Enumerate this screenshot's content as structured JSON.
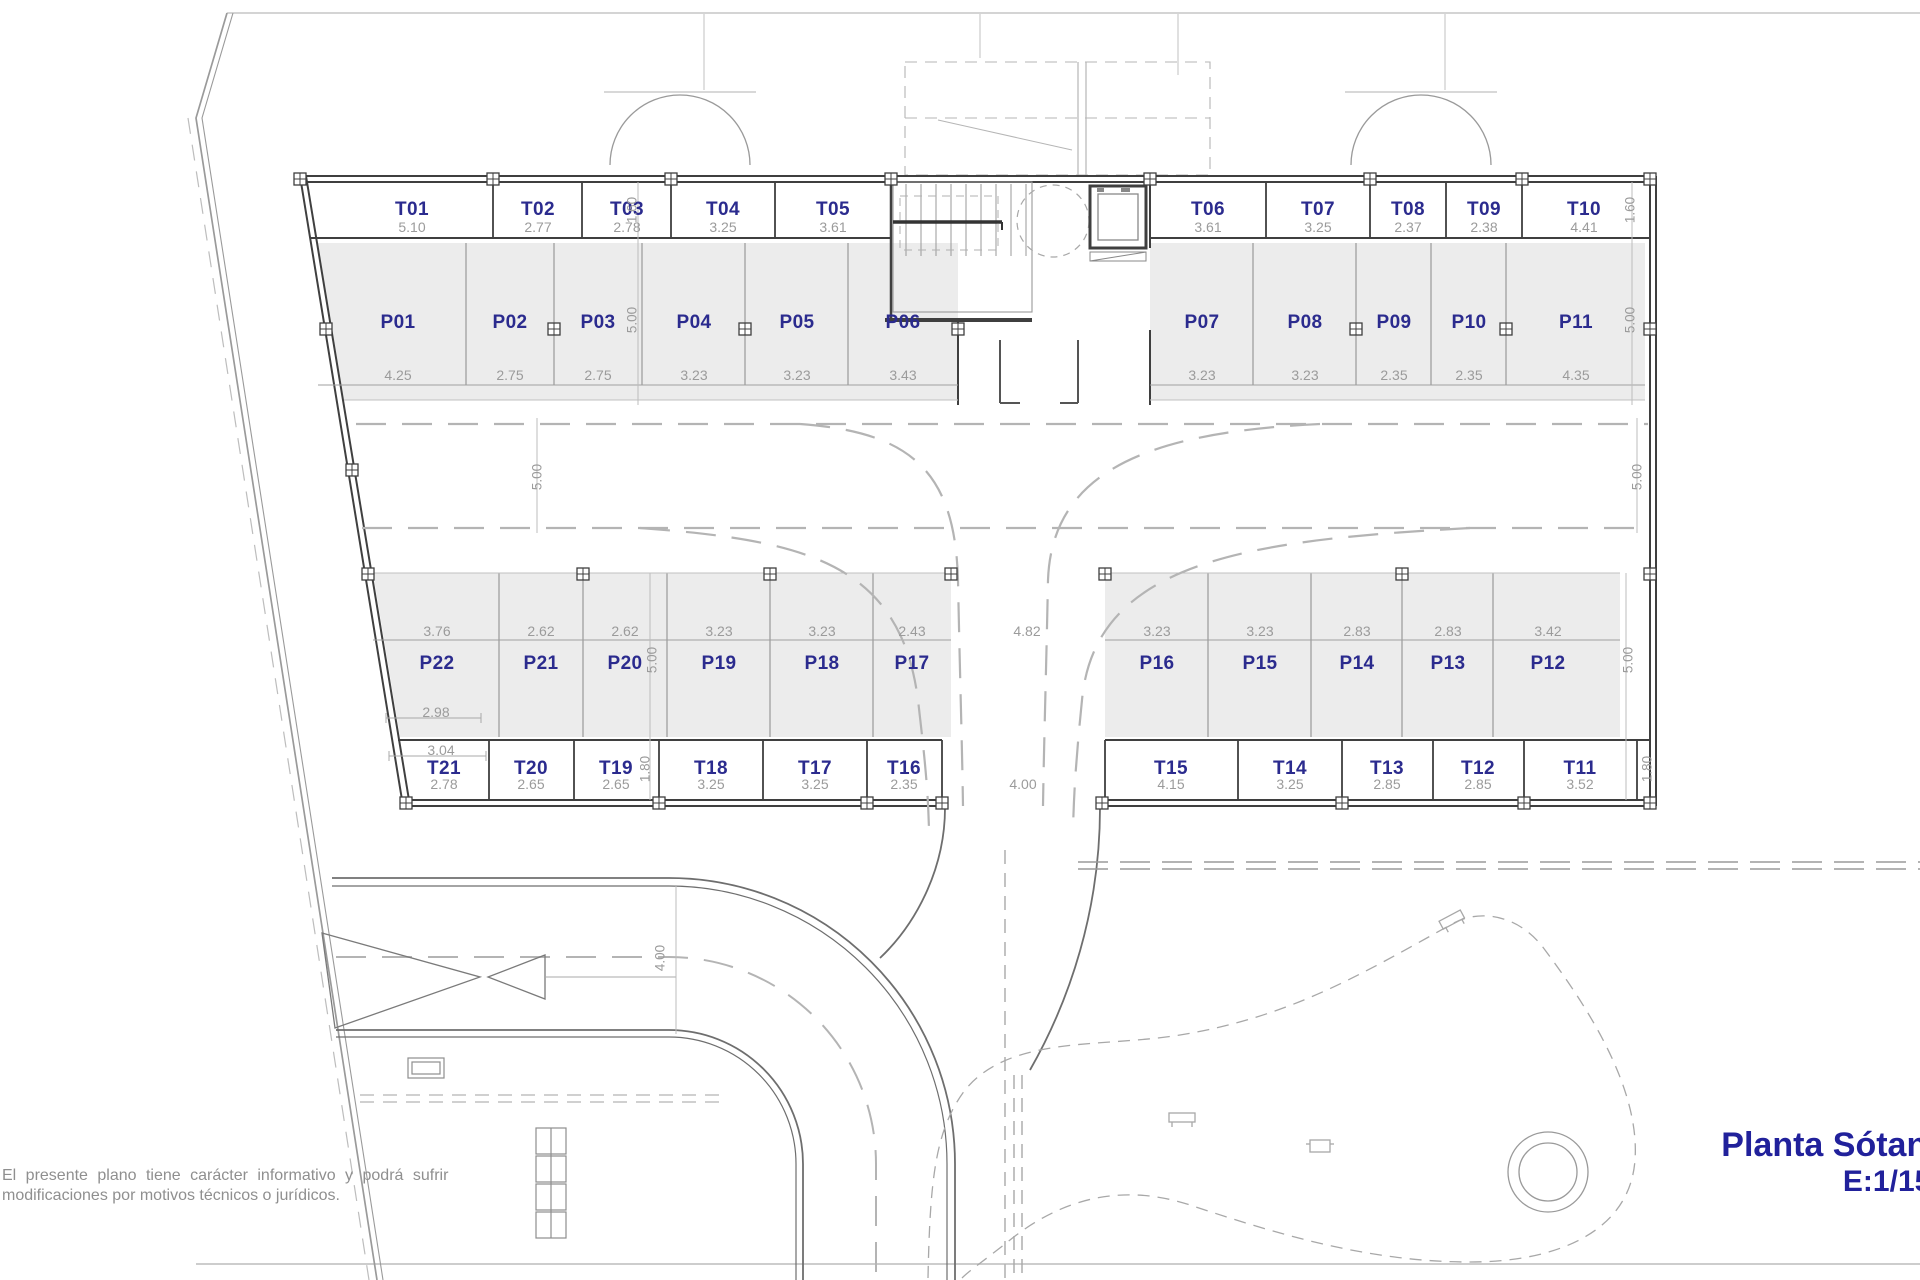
{
  "plan": {
    "title": "Planta Sótano",
    "scale": "E:1/150"
  },
  "disclaimer": {
    "line1": "El presente plano tiene carácter informativo y podrá sufrir",
    "line2": "modificaciones por motivos técnicos o jurídicos."
  },
  "colors": {
    "label_blue": "#2b2b8e",
    "dim_gray": "#9b9b9b",
    "stall_fill": "#ececec",
    "wall_dark": "#3f3f3f",
    "title_blue": "#21219b"
  },
  "storage_top": [
    {
      "id": "T01",
      "dim": "5.10"
    },
    {
      "id": "T02",
      "dim": "2.77"
    },
    {
      "id": "T03",
      "dim": "2.78"
    },
    {
      "id": "T04",
      "dim": "3.25"
    },
    {
      "id": "T05",
      "dim": "3.61"
    },
    {
      "id": "T06",
      "dim": "3.61"
    },
    {
      "id": "T07",
      "dim": "3.25"
    },
    {
      "id": "T08",
      "dim": "2.37"
    },
    {
      "id": "T09",
      "dim": "2.38"
    },
    {
      "id": "T10",
      "dim": "4.41"
    }
  ],
  "parking_top": [
    {
      "id": "P01",
      "dim": "4.25"
    },
    {
      "id": "P02",
      "dim": "2.75"
    },
    {
      "id": "P03",
      "dim": "2.75"
    },
    {
      "id": "P04",
      "dim": "3.23"
    },
    {
      "id": "P05",
      "dim": "3.23"
    },
    {
      "id": "P06",
      "dim": "3.43"
    },
    {
      "id": "P07",
      "dim": "3.23"
    },
    {
      "id": "P08",
      "dim": "3.23"
    },
    {
      "id": "P09",
      "dim": "2.35"
    },
    {
      "id": "P10",
      "dim": "2.35"
    },
    {
      "id": "P11",
      "dim": "4.35"
    }
  ],
  "parking_bottom": [
    {
      "id": "P22",
      "dim": "3.76"
    },
    {
      "id": "P21",
      "dim": "2.62"
    },
    {
      "id": "P20",
      "dim": "2.62"
    },
    {
      "id": "P19",
      "dim": "3.23"
    },
    {
      "id": "P18",
      "dim": "3.23"
    },
    {
      "id": "P17",
      "dim": "2.43"
    },
    {
      "id": "P16",
      "dim": "3.23"
    },
    {
      "id": "P15",
      "dim": "3.23"
    },
    {
      "id": "P14",
      "dim": "2.83"
    },
    {
      "id": "P13",
      "dim": "2.83"
    },
    {
      "id": "P12",
      "dim": "3.42"
    }
  ],
  "storage_bottom": [
    {
      "id": "T21",
      "dim": "2.78"
    },
    {
      "id": "T20",
      "dim": "2.65"
    },
    {
      "id": "T19",
      "dim": "2.65"
    },
    {
      "id": "T18",
      "dim": "3.25"
    },
    {
      "id": "T17",
      "dim": "3.25"
    },
    {
      "id": "T16",
      "dim": "2.35"
    },
    {
      "id": "T15",
      "dim": "4.15"
    },
    {
      "id": "T14",
      "dim": "3.25"
    },
    {
      "id": "T13",
      "dim": "2.85"
    },
    {
      "id": "T12",
      "dim": "2.85"
    },
    {
      "id": "T11",
      "dim": "3.52"
    }
  ],
  "dims": {
    "center_parking": "4.82",
    "center_storage": "4.00",
    "ramp_width": "4.00",
    "p22_lower": "2.98",
    "t21_upper": "3.04",
    "left": {
      "t_top": "1.60",
      "p_top": "5.00",
      "aisle": "5.00",
      "p_bottom": "5.00",
      "t_bottom": "1.80"
    },
    "right": {
      "t_top": "1.60",
      "p_top": "5.00",
      "aisle": "5.00",
      "p_bottom": "5.00",
      "t_bottom": "1.80"
    }
  }
}
